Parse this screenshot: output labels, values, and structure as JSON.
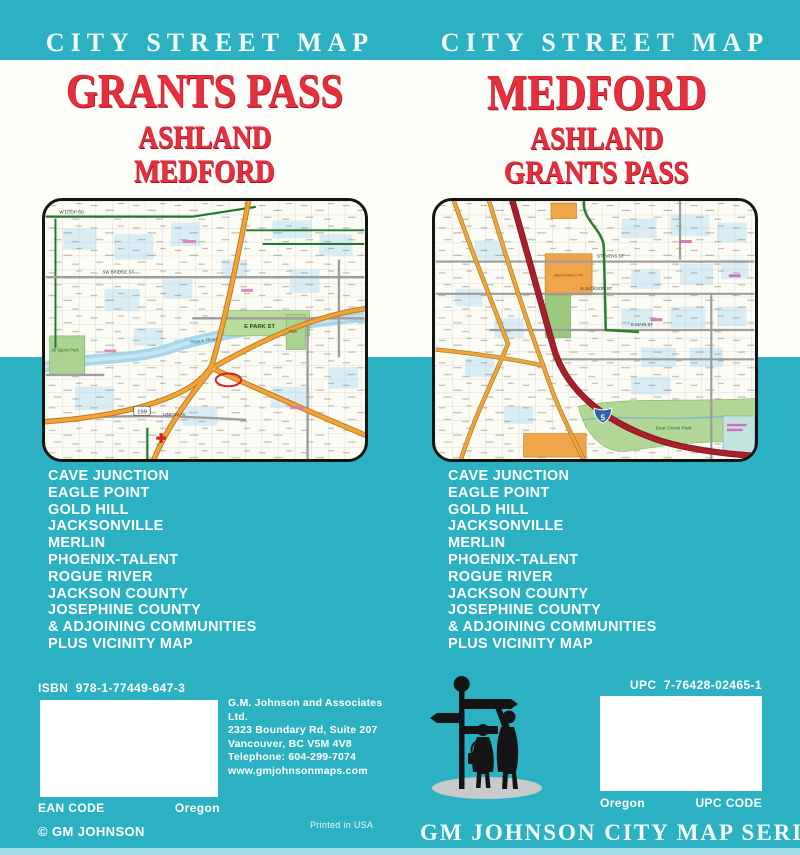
{
  "colors": {
    "teal": "#2bb1c2",
    "title_red": "#e62e3d",
    "highway_orange": "#f1a33c",
    "interstate_maroon": "#a81f2c",
    "river_blue": "#a6d7e9",
    "park_green": "#abd28e"
  },
  "header": {
    "left": "CITY STREET MAP",
    "right": "CITY STREET MAP"
  },
  "left_panel": {
    "title_lines": [
      "GRANTS PASS",
      "ASHLAND",
      "MEDFORD"
    ]
  },
  "right_panel": {
    "title_lines": [
      "MEDFORD",
      "ASHLAND",
      "GRANTS PASS"
    ]
  },
  "city_list": [
    "CAVE JUNCTION",
    "EAGLE POINT",
    "GOLD HILL",
    "JACKSONVILLE",
    "MERLIN",
    "PHOENIX-TALENT",
    "ROGUE RIVER",
    "JACKSON COUNTY",
    "JOSEPHINE COUNTY",
    "& ADJOINING COMMUNITIES",
    "PLUS VICINITY MAP"
  ],
  "left_map_labels": {
    "loop_rd": "W LOOP RD",
    "bridge_st": "SW BRIDGE ST",
    "park_st": "E PARK ST",
    "union_av": "UNION AV",
    "hwy199": "199",
    "sports_park": "All Sports Park",
    "park": "Park",
    "river": "Rogue River"
  },
  "right_map_labels": {
    "stevens_st": "STEVENS ST",
    "jackson_st": "N JACKSON ST",
    "main_st": "E MAIN ST",
    "bear_creek": "Bear Creek Park",
    "medford_ctr": "MEDFORD CTR",
    "i5": "5"
  },
  "footer_left": {
    "isbn_label": "ISBN",
    "isbn": "978-1-77449-647-3",
    "ean_code": "EAN CODE",
    "region": "Oregon",
    "copyright": "© GM JOHNSON"
  },
  "publisher": {
    "line1": "G.M. Johnson and Associates Ltd.",
    "line2": "2323 Boundary Rd, Suite 207",
    "line3": "Vancouver, BC  V5M 4V8",
    "line4": "Telephone:  604-299-7074",
    "line5": "www.gmjohnsonmaps.com",
    "printed": "Printed in USA"
  },
  "footer_right": {
    "upc_label": "UPC",
    "upc": "7-76428-02465-1",
    "region": "Oregon",
    "upc_code": "UPC CODE",
    "series": "GM JOHNSON CITY MAP SERIES"
  }
}
